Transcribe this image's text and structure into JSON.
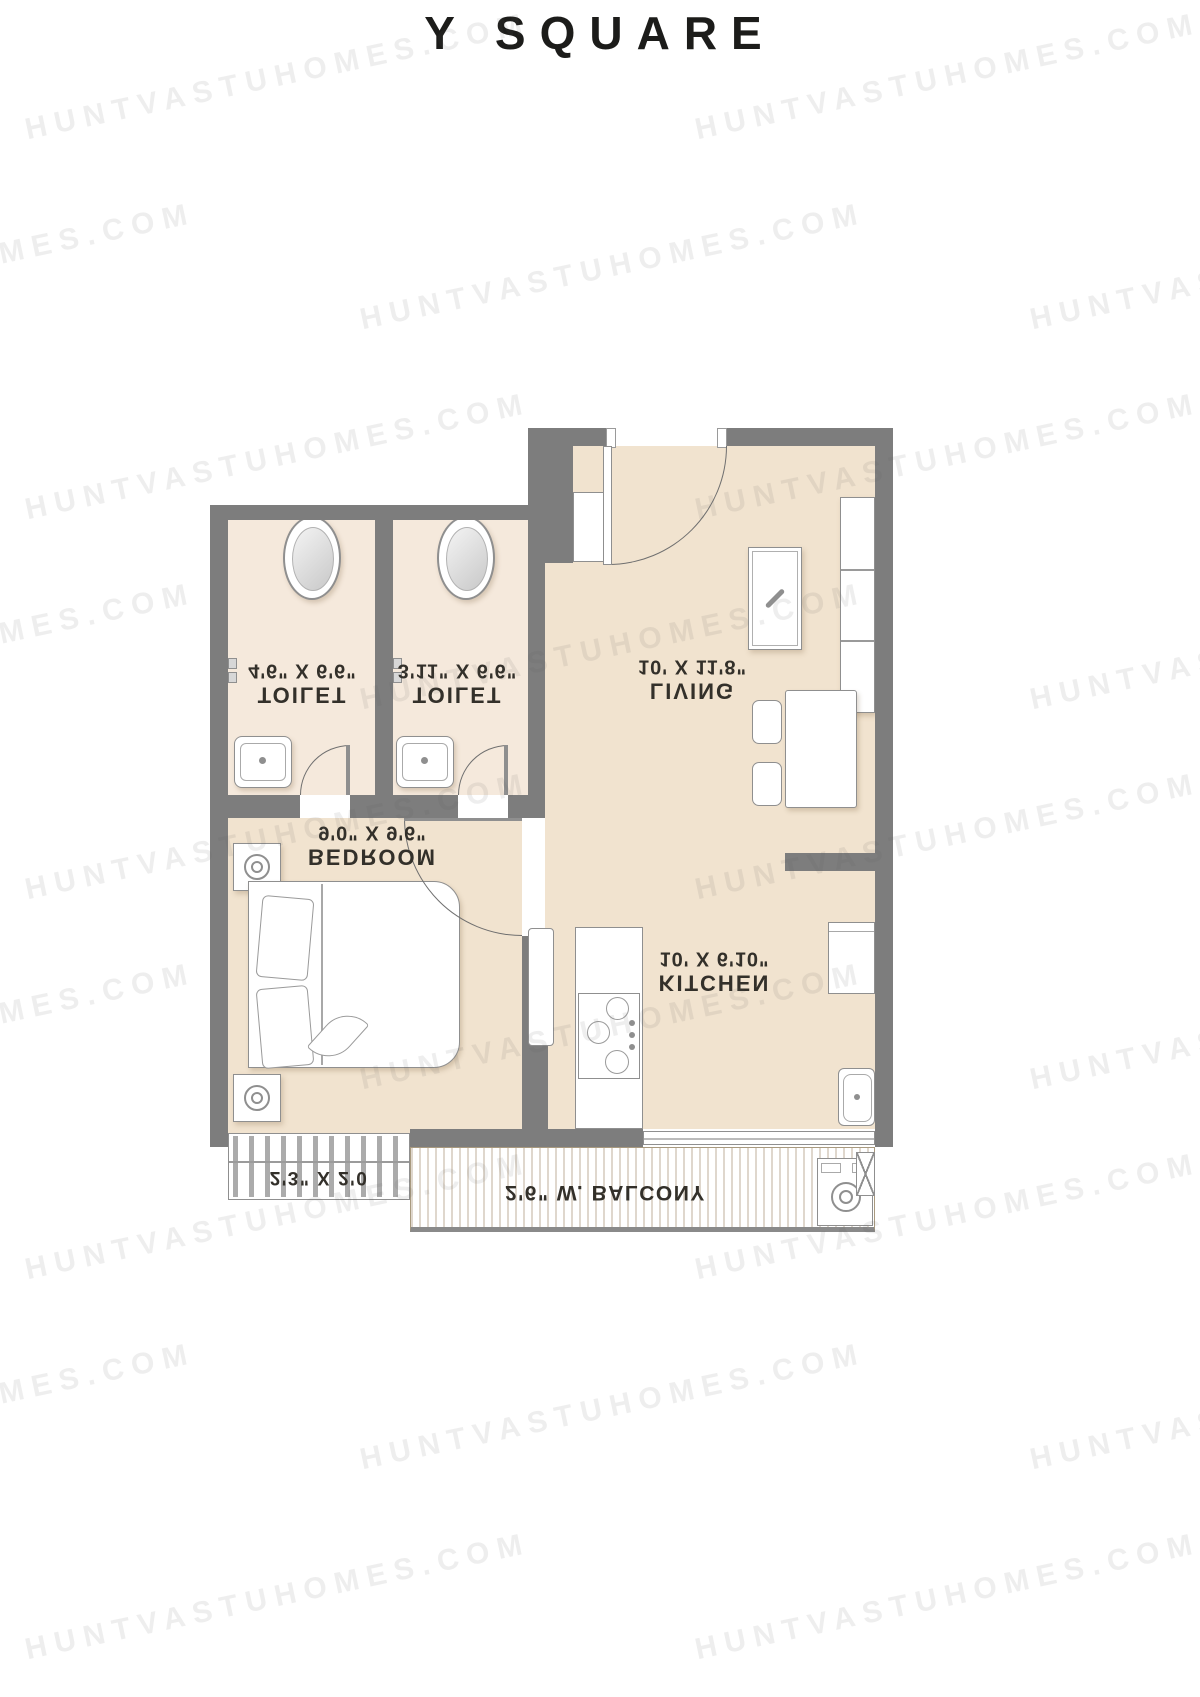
{
  "title": "Y SQUARE",
  "watermark": {
    "text": "HUNTVASTUHOMES.COM"
  },
  "colors": {
    "wall": "#7d7d7d",
    "floor": "#f1e3cf",
    "toilet_floor": "#f5e9dc",
    "balcony_floor": "#d5bf9f",
    "label_text": "#33302a",
    "title_text": "#1c1c1a"
  },
  "rooms": {
    "toilet1": {
      "name": "TOILET",
      "dims": "4'6\" X 6'6\""
    },
    "toilet2": {
      "name": "TOILET",
      "dims": "3'11\" X 6'6\""
    },
    "living": {
      "name": "LIVING",
      "dims": "10' X 11'8\""
    },
    "bedroom": {
      "name": "BEDROOM",
      "dims": "9'0\" X 9'6\""
    },
    "kitchen": {
      "name": "KITCHEN",
      "dims": "10' X 6'10\""
    },
    "balcony": {
      "label": "2'6\" W. BALCONY"
    },
    "ledge": {
      "label": "2'3\" X 2'0"
    }
  }
}
